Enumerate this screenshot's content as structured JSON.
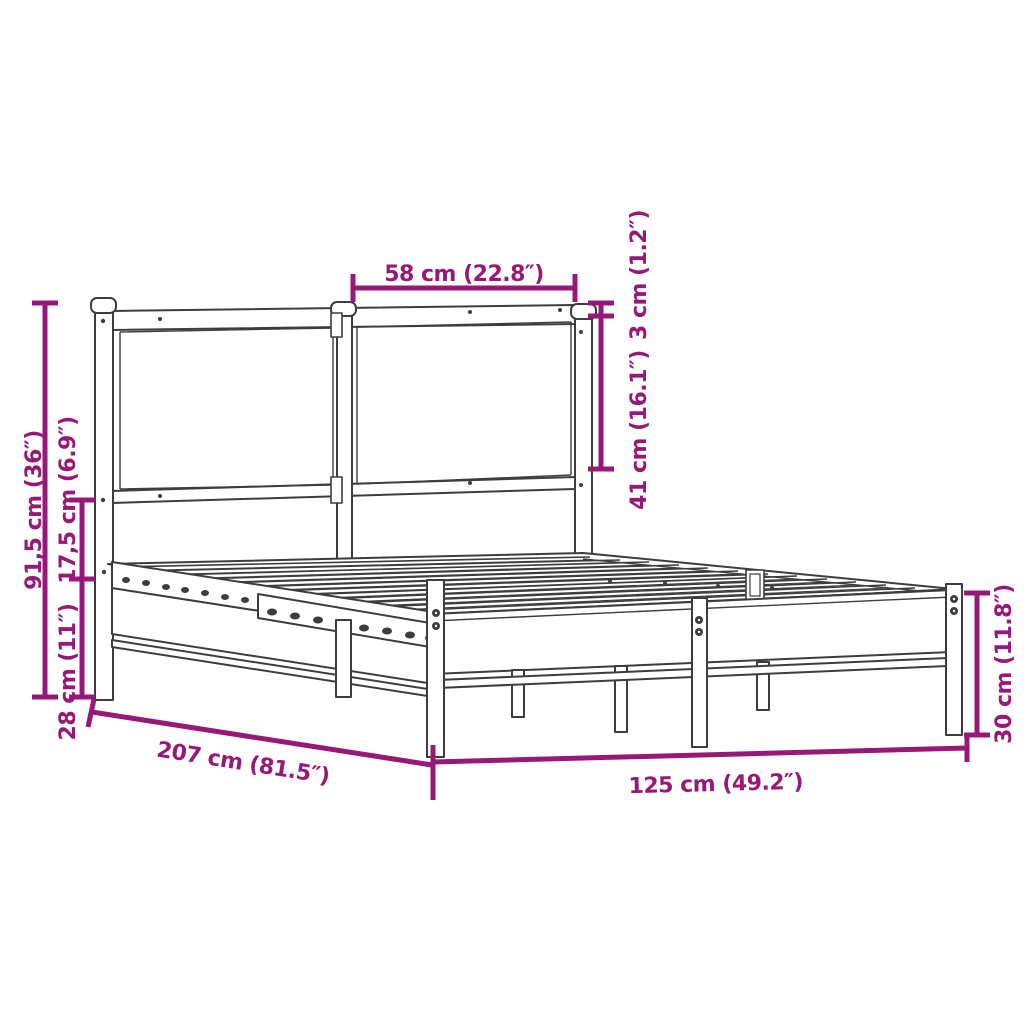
{
  "diagram": {
    "type": "product-dimension-diagram",
    "subject": "metal bed frame with headboard",
    "background_color": "#ffffff",
    "outline_color": "#3d3d3d",
    "dimension_color": "#981878",
    "labels": {
      "headboard_panel_width": "58 cm (22.8″)",
      "top_rail_thickness": "3 cm (1.2″)",
      "headboard_panel_height": "41 cm (16.1″)",
      "headboard_total_height": "91,5 cm (36″)",
      "rail_to_platform_gap": "17,5 cm (6.9″)",
      "under_bed_clearance": "28 cm (11″)",
      "bed_length": "207 cm (81.5″)",
      "bed_width": "125 cm (49.2″)",
      "foot_end_height": "30 cm (11.8″)"
    }
  }
}
